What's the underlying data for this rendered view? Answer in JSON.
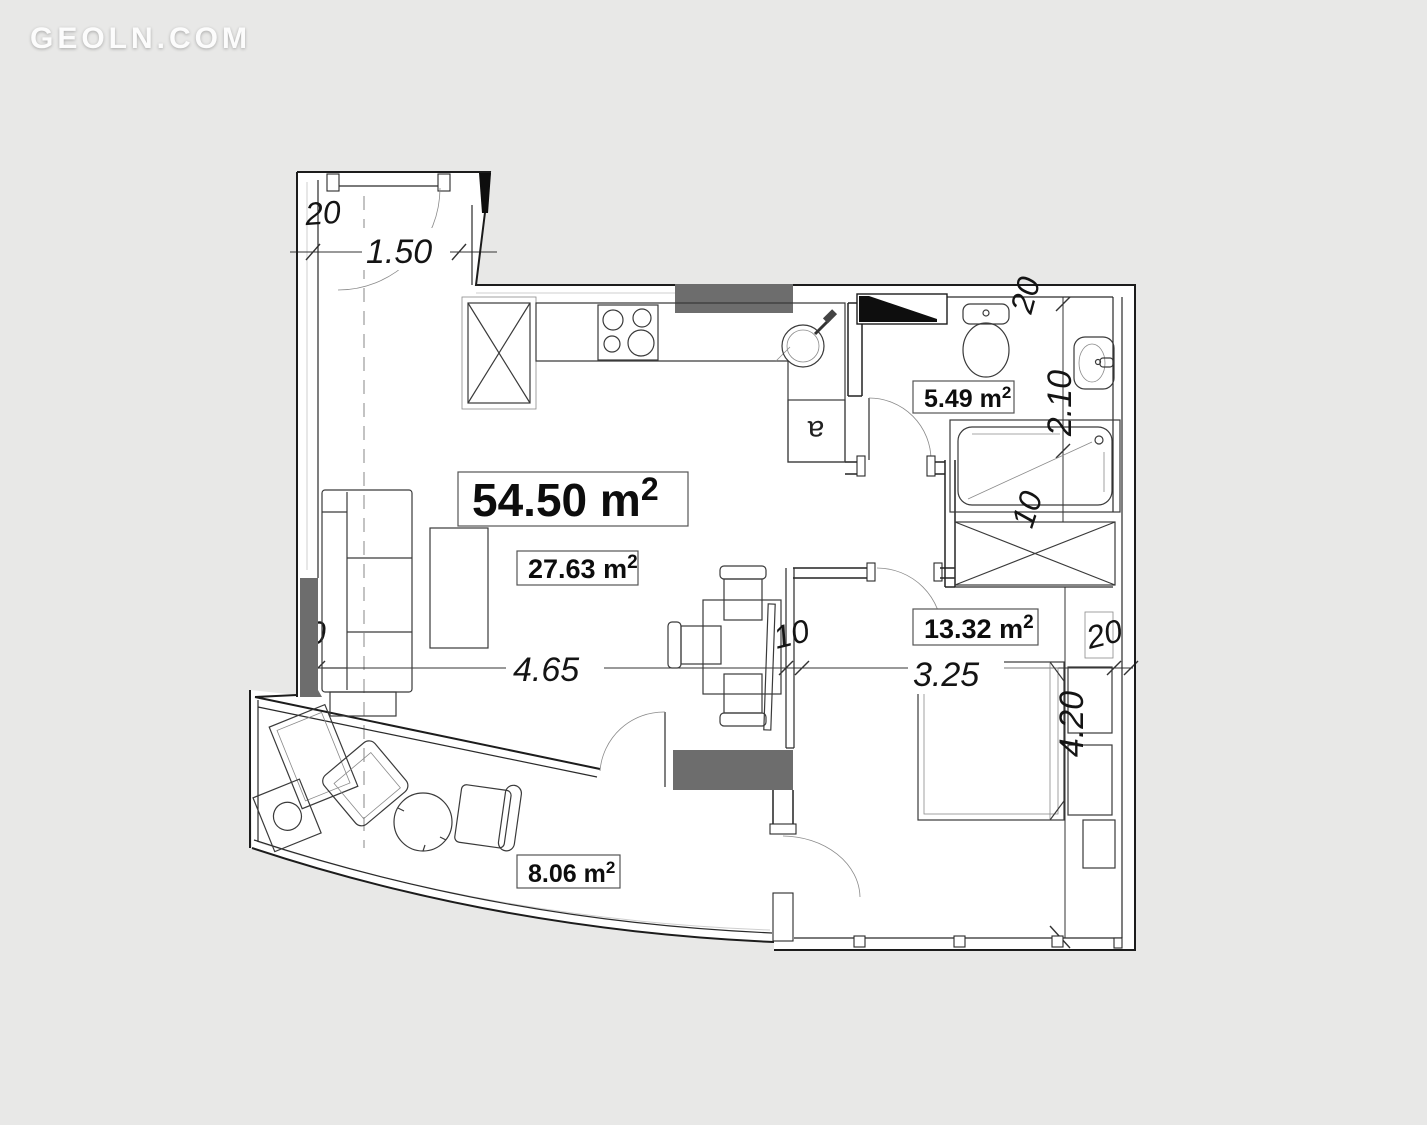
{
  "watermark": {
    "text": "GEOLN.COM"
  },
  "colors": {
    "background": "#e8e8e7",
    "floor": "#ffffff",
    "wall_fill_dark": "#6d6d6d",
    "wall_fill_black": "#0e0e0e",
    "line": "#1c1c1c",
    "label_text": "#111111"
  },
  "plan": {
    "total_area": {
      "value": "54.50",
      "unit": " m",
      "sup": "2"
    },
    "rooms": [
      {
        "id": "living-room",
        "value": "27.63",
        "unit": " m",
        "sup": "2"
      },
      {
        "id": "bathroom",
        "value": "5.49",
        "unit": " m",
        "sup": "2"
      },
      {
        "id": "bedroom",
        "value": "13.32",
        "unit": " m",
        "sup": "2"
      },
      {
        "id": "balcony",
        "value": "8.06",
        "unit": " m",
        "sup": "2"
      }
    ],
    "dimensions": {
      "entry_wall_thickness": "20",
      "entry_door_width": "1.50",
      "bath_wall_thickness": "20",
      "bath_width": "2.10",
      "bath_lower_wall": "10",
      "living_width": "4.65",
      "partition_thickness": "10",
      "bedroom_width": "3.25",
      "bedroom_wall_thickness": "20",
      "bedroom_depth": "4.20",
      "left_wall_clipped": "0"
    },
    "appliance_label": "a"
  }
}
